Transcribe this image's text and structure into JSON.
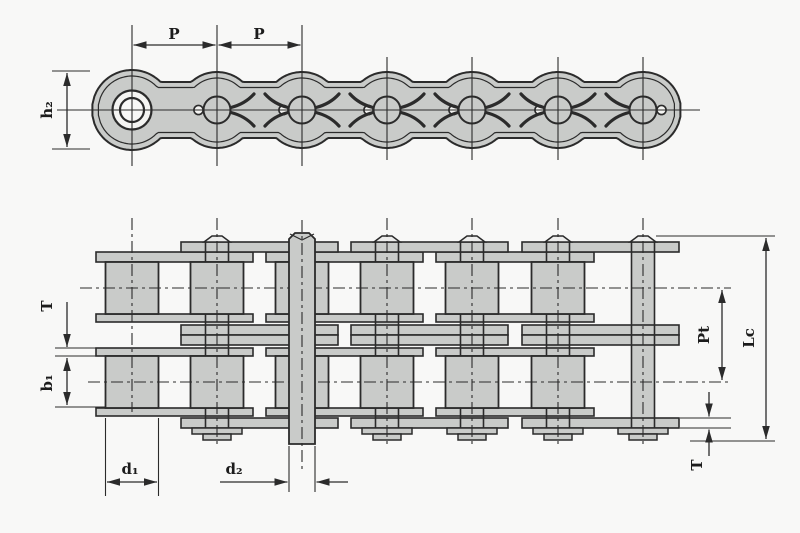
{
  "drawing": {
    "type": "roller-chain engineering drawing",
    "views": {
      "top": "single strand side elevation",
      "bottom": "duplex strand plan view"
    }
  },
  "labels": {
    "pitch_left": "P",
    "pitch_right": "P",
    "plate_height": "h₂",
    "plate_thickness_left": "T",
    "inner_width": "b₁",
    "roller_diameter": "d₁",
    "pin_diameter": "d₂",
    "transverse_pitch": "Pt",
    "pin_length": "Lc",
    "plate_thickness_right": "T"
  },
  "colors": {
    "background": "#f8f8f7",
    "chain_fill": "#c9cbc9",
    "line": "#2b2b2b",
    "label": "#1c1c1c",
    "hole_fill": "#f4f4f2",
    "head_fill": "#ededec"
  }
}
